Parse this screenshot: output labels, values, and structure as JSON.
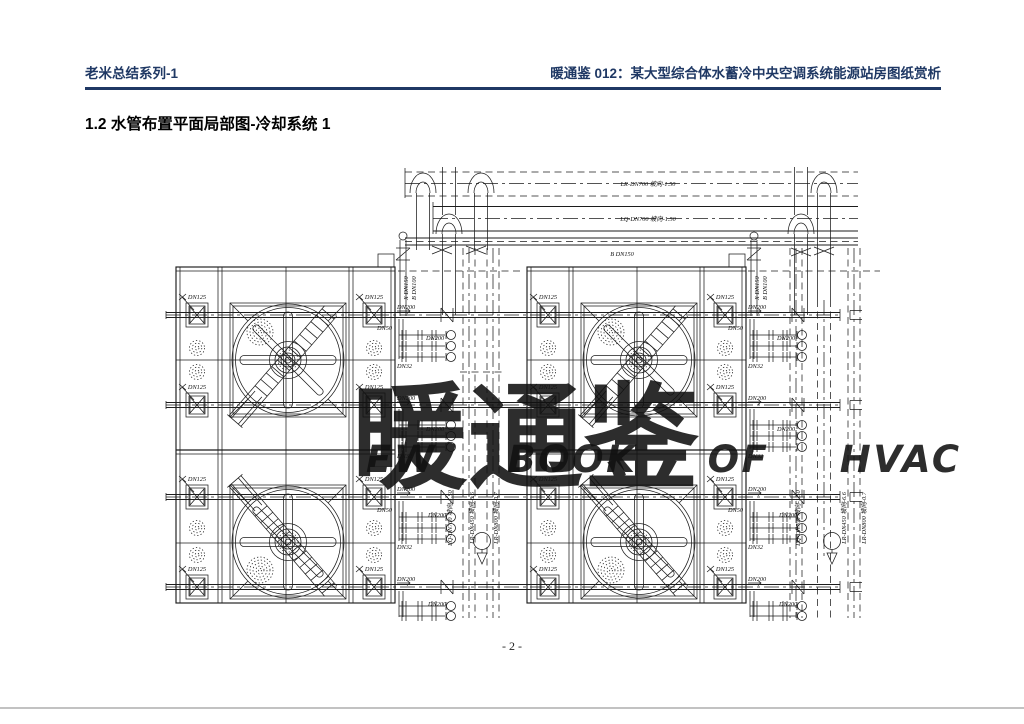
{
  "header": {
    "series": "老米总结系列-1",
    "title": "暖通鉴 012：某大型综合体水蓄冷中央空调系统能源站房图纸赏析",
    "color": "#1f3864"
  },
  "section": {
    "title": "1.2 水管布置平面局部图-冷却系统 1"
  },
  "footer": {
    "page_number": "- 2 -"
  },
  "watermark": {
    "main": "暖通鉴",
    "sub": "EW BOOK OF HVAC",
    "color": "#3EC8F5"
  },
  "drawing": {
    "line_color": "#1c1c1c",
    "labels": {
      "dn125": "DN125",
      "dn50": "DN50",
      "dn200": "DN200",
      "dn32": "DN32",
      "top_pipe_1": "LR-DN700 坡向-1.50",
      "top_pipe_2": "LQ-DN700 坡向-1.50",
      "top_pipe_3": "B DN150",
      "riser_a": "X DN150",
      "riser_b": "B DN100",
      "vpipe_1": "LQ-DN700 坡向-1.50",
      "vpipe_2": "LR-DN450 坡向-6.6",
      "vpipe_3": "LR-DN800 坡向-0.7"
    }
  }
}
